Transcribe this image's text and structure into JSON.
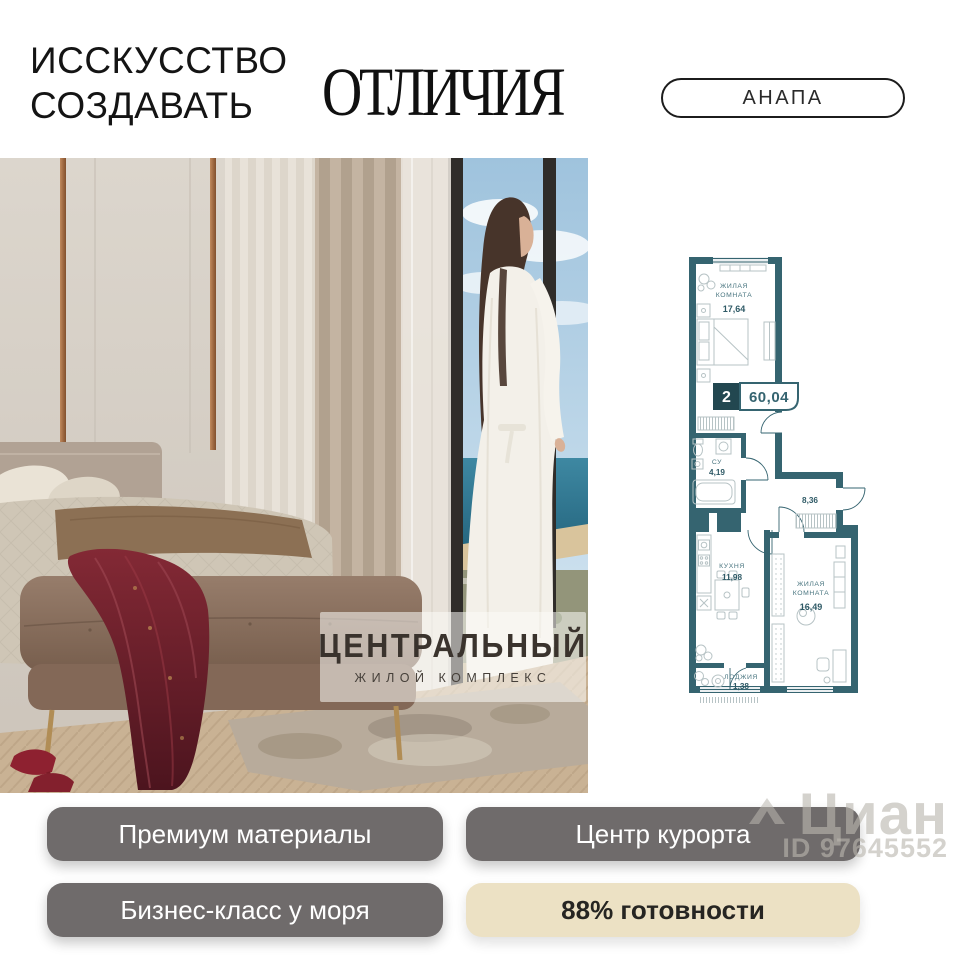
{
  "header": {
    "tagline_line1": "ИССКУССТВО",
    "tagline_line2": "СОЗДАВАТЬ",
    "brand_word": "ОТЛИЧИЯ",
    "location_badge": "АНАПА"
  },
  "hero": {
    "logo_title": "ЦЕНТРАЛЬНЫЙ",
    "logo_subtitle": "ЖИЛОЙ КОМПЛЕКС"
  },
  "floor_plan": {
    "badge_rooms": "2",
    "badge_area": "60,04",
    "room1_l1": "ЖИЛАЯ",
    "room1_l2": "КОМНАТА",
    "room1_area": "17,64",
    "bath_l1": "СУ",
    "bath_area": "4,19",
    "hall_area": "8,36",
    "kitchen_l1": "КУХНЯ",
    "kitchen_area": "11,98",
    "room2_l1": "ЖИЛАЯ",
    "room2_l2": "КОМНАТА",
    "room2_area": "16,49",
    "loggia_l1": "ЛОДЖИЯ",
    "loggia_area": "1,38"
  },
  "features": [
    {
      "label": "Премиум материалы",
      "style": "gray"
    },
    {
      "label": "Центр курорта",
      "style": "gray"
    },
    {
      "label": "Бизнес-класс у моря",
      "style": "gray"
    },
    {
      "label": "88% готовности",
      "style": "beige"
    }
  ],
  "watermark": {
    "brand": "Циан",
    "id": "ID 97645552"
  },
  "colors": {
    "plan_wall_teal": "#356470",
    "plan_badge_dark": "#224750",
    "button_gray": "#6F6B6B",
    "badge_beige": "#ECE1C4",
    "header_text": "#141414"
  }
}
